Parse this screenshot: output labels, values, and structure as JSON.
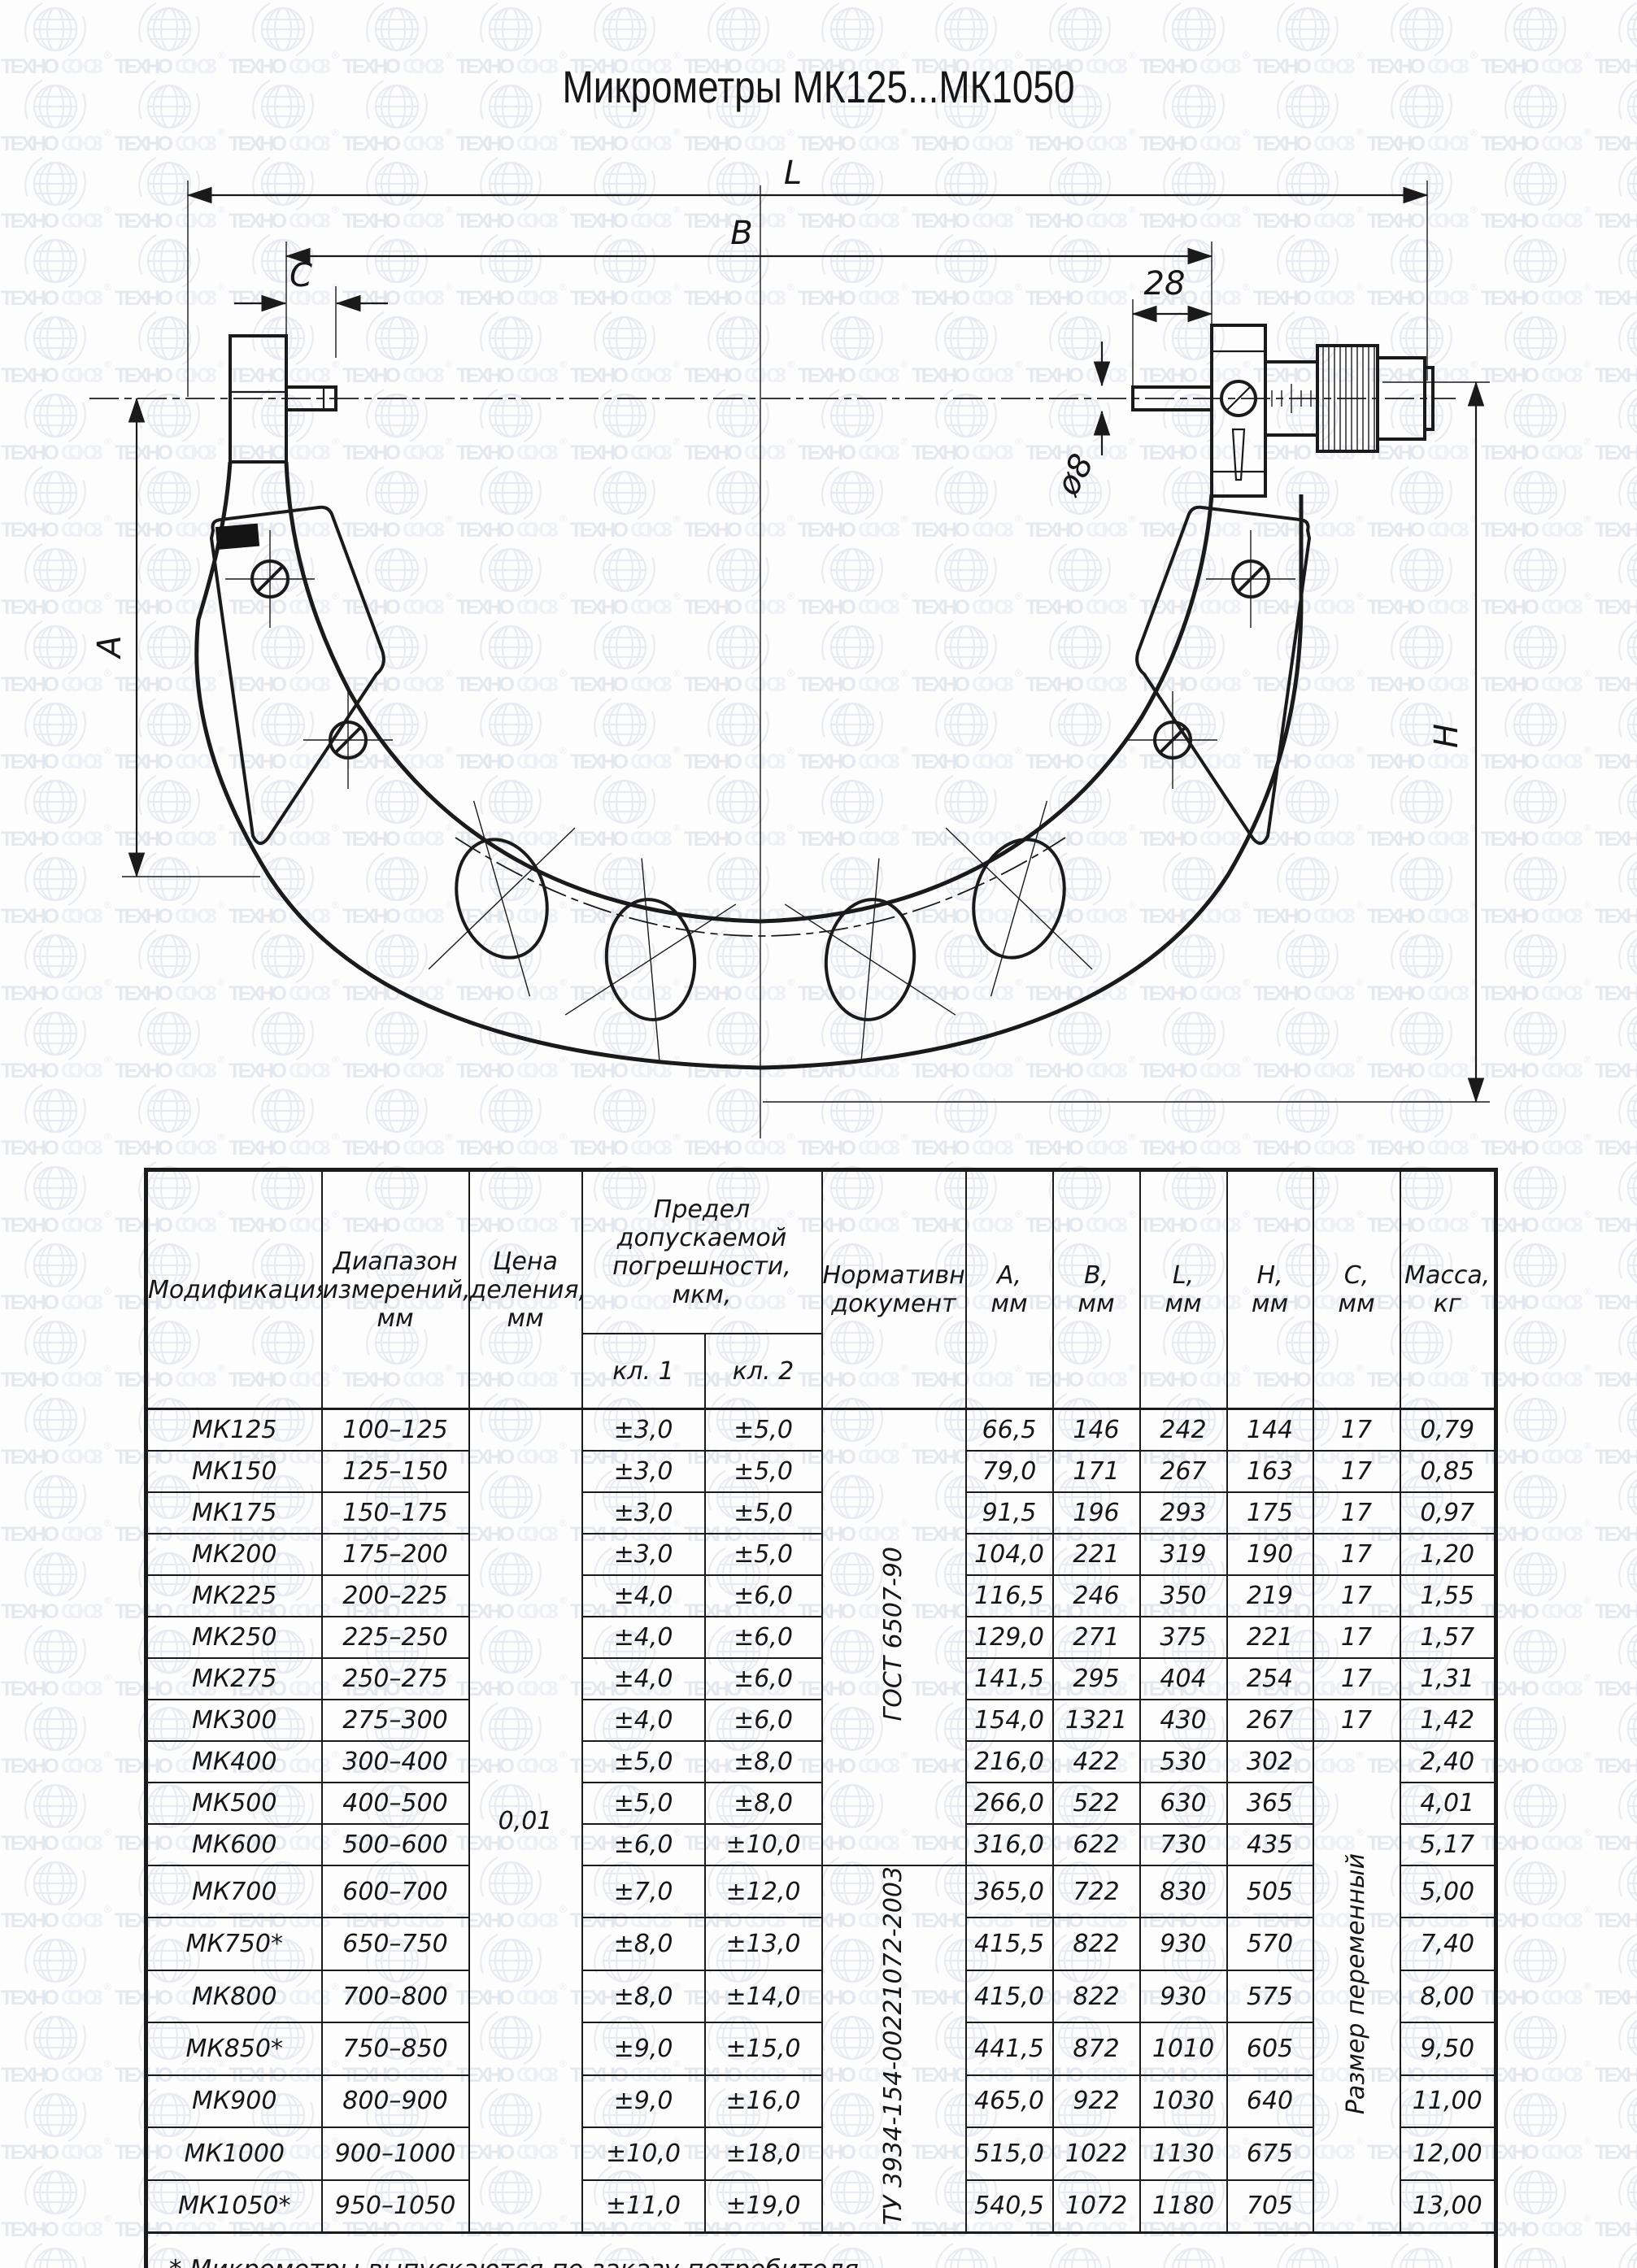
{
  "title": "Микрометры МК125...МК1050",
  "watermark": {
    "brand_bold": "ТЕХНО",
    "brand_light": "СОЮЗ",
    "reg": "®"
  },
  "drawing": {
    "labels": {
      "L": "L",
      "B": "B",
      "C": "C",
      "len28": "28",
      "dia8": "ø8",
      "A": "A",
      "H": "H"
    }
  },
  "table": {
    "headers": {
      "modification": "Модификация",
      "range": "Диапазон\nизмерений,\nмм",
      "division": "Цена\nделения,\nмм",
      "error_limit": "Предел допускаемой\nпогрешности, мкм,",
      "class1": "кл. 1",
      "class2": "кл. 2",
      "document": "Нормативный\nдокумент",
      "col_a": "А,\nмм",
      "col_b": "В,\nмм",
      "col_l": "L,\nмм",
      "col_h": "Н,\nмм",
      "col_c": "С,\nмм",
      "col_mass": "Масса,\nкг"
    },
    "division_value": "0,01",
    "doc_gost": "ГОСТ 6507-90",
    "doc_tu": "ТУ 3934-154-00221072-2003",
    "c_variable": "Размер переменный",
    "doc_gost_rows": 11,
    "c_fixed_rows": 8,
    "rows": [
      {
        "mod": "МК125",
        "range": "100–125",
        "cl1": "±3,0",
        "cl2": "±5,0",
        "a": "66,5",
        "b": "146",
        "l": "242",
        "h": "144",
        "c": "17",
        "mass": "0,79"
      },
      {
        "mod": "МК150",
        "range": "125–150",
        "cl1": "±3,0",
        "cl2": "±5,0",
        "a": "79,0",
        "b": "171",
        "l": "267",
        "h": "163",
        "c": "17",
        "mass": "0,85"
      },
      {
        "mod": "МК175",
        "range": "150–175",
        "cl1": "±3,0",
        "cl2": "±5,0",
        "a": "91,5",
        "b": "196",
        "l": "293",
        "h": "175",
        "c": "17",
        "mass": "0,97"
      },
      {
        "mod": "МК200",
        "range": "175–200",
        "cl1": "±3,0",
        "cl2": "±5,0",
        "a": "104,0",
        "b": "221",
        "l": "319",
        "h": "190",
        "c": "17",
        "mass": "1,20"
      },
      {
        "mod": "МК225",
        "range": "200–225",
        "cl1": "±4,0",
        "cl2": "±6,0",
        "a": "116,5",
        "b": "246",
        "l": "350",
        "h": "219",
        "c": "17",
        "mass": "1,55"
      },
      {
        "mod": "МК250",
        "range": "225–250",
        "cl1": "±4,0",
        "cl2": "±6,0",
        "a": "129,0",
        "b": "271",
        "l": "375",
        "h": "221",
        "c": "17",
        "mass": "1,57"
      },
      {
        "mod": "МК275",
        "range": "250–275",
        "cl1": "±4,0",
        "cl2": "±6,0",
        "a": "141,5",
        "b": "295",
        "l": "404",
        "h": "254",
        "c": "17",
        "mass": "1,31"
      },
      {
        "mod": "МК300",
        "range": "275–300",
        "cl1": "±4,0",
        "cl2": "±6,0",
        "a": "154,0",
        "b": "1321",
        "l": "430",
        "h": "267",
        "c": "17",
        "mass": "1,42"
      },
      {
        "mod": "МК400",
        "range": "300–400",
        "cl1": "±5,0",
        "cl2": "±8,0",
        "a": "216,0",
        "b": "422",
        "l": "530",
        "h": "302",
        "c": "",
        "mass": "2,40"
      },
      {
        "mod": "МК500",
        "range": "400–500",
        "cl1": "±5,0",
        "cl2": "±8,0",
        "a": "266,0",
        "b": "522",
        "l": "630",
        "h": "365",
        "c": "",
        "mass": "4,01"
      },
      {
        "mod": "МК600",
        "range": "500–600",
        "cl1": "±6,0",
        "cl2": "±10,0",
        "a": "316,0",
        "b": "622",
        "l": "730",
        "h": "435",
        "c": "",
        "mass": "5,17"
      },
      {
        "mod": "МК700",
        "range": "600–700",
        "cl1": "±7,0",
        "cl2": "±12,0",
        "a": "365,0",
        "b": "722",
        "l": "830",
        "h": "505",
        "c": "",
        "mass": "5,00"
      },
      {
        "mod": "МК750*",
        "range": "650–750",
        "cl1": "±8,0",
        "cl2": "±13,0",
        "a": "415,5",
        "b": "822",
        "l": "930",
        "h": "570",
        "c": "",
        "mass": "7,40"
      },
      {
        "mod": "МК800",
        "range": "700–800",
        "cl1": "±8,0",
        "cl2": "±14,0",
        "a": "415,0",
        "b": "822",
        "l": "930",
        "h": "575",
        "c": "",
        "mass": "8,00"
      },
      {
        "mod": "МК850*",
        "range": "750–850",
        "cl1": "±9,0",
        "cl2": "±15,0",
        "a": "441,5",
        "b": "872",
        "l": "1010",
        "h": "605",
        "c": "",
        "mass": "9,50"
      },
      {
        "mod": "МК900",
        "range": "800–900",
        "cl1": "±9,0",
        "cl2": "±16,0",
        "a": "465,0",
        "b": "922",
        "l": "1030",
        "h": "640",
        "c": "",
        "mass": "11,00"
      },
      {
        "mod": "МК1000",
        "range": "900–1000",
        "cl1": "±10,0",
        "cl2": "±18,0",
        "a": "515,0",
        "b": "1022",
        "l": "1130",
        "h": "675",
        "c": "",
        "mass": "12,00"
      },
      {
        "mod": "МК1050*",
        "range": "950–1050",
        "cl1": "±11,0",
        "cl2": "±19,0",
        "a": "540,5",
        "b": "1072",
        "l": "1180",
        "h": "705",
        "c": "",
        "mass": "13,00"
      }
    ],
    "footnote": "* Микрометры выпускаются по заказу потребителя"
  }
}
